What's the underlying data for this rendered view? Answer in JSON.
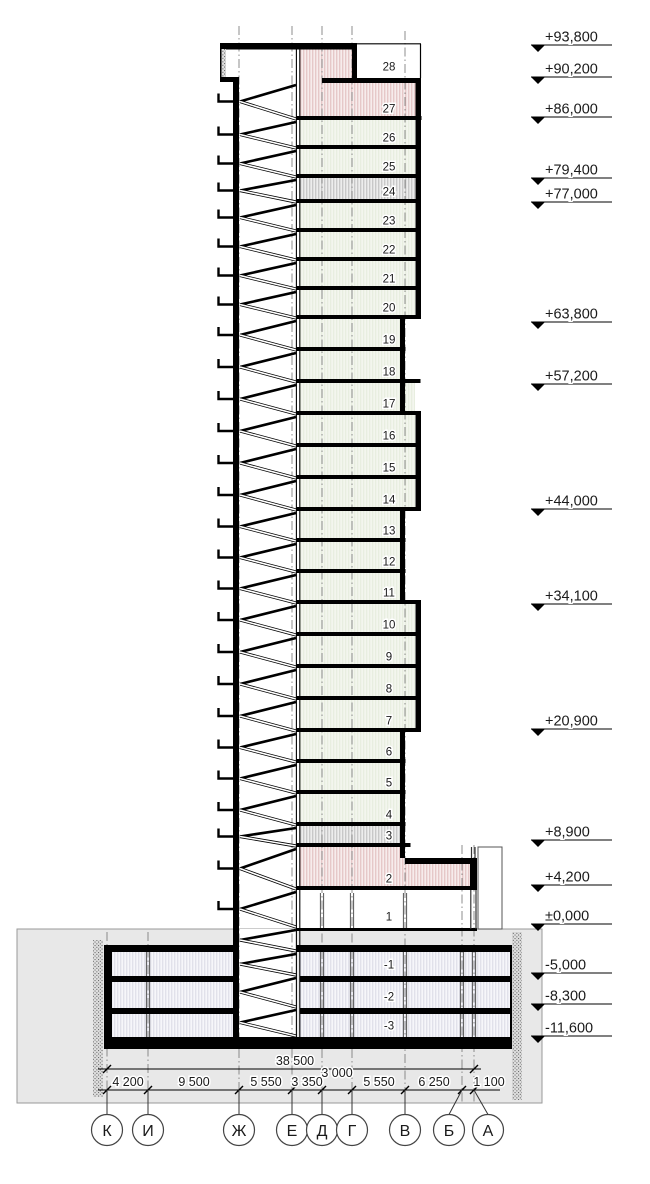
{
  "drawing_type": "building-section",
  "colors": {
    "structure": "#000000",
    "ground": "#e8e8e8",
    "unit_floor": "#f3f6ee",
    "tech_floor_stripe": "#b5b5b5",
    "pink_floor_stripe": "#dcb4b4",
    "pink_floor_bg": "#f7ecec",
    "basement_stripe": "#d6d6e2",
    "axis_line": "#808080"
  },
  "floors": [
    {
      "label": "28",
      "y1": 45,
      "y2": 78,
      "x1": 357,
      "x2": 420,
      "fill": "white"
    },
    {
      "label": "27",
      "y1": 83,
      "y2": 120,
      "x1": 300,
      "x2": 416,
      "fill": "pink"
    },
    {
      "label": "26",
      "y1": 120,
      "y2": 149,
      "x1": 300,
      "x2": 415,
      "fill": "unit"
    },
    {
      "label": "25",
      "y1": 149,
      "y2": 178,
      "x1": 300,
      "x2": 415,
      "fill": "unit"
    },
    {
      "label": "24",
      "y1": 178,
      "y2": 203,
      "x1": 300,
      "x2": 415,
      "fill": "tech"
    },
    {
      "label": "23",
      "y1": 203,
      "y2": 232,
      "x1": 300,
      "x2": 415,
      "fill": "unit"
    },
    {
      "label": "22",
      "y1": 232,
      "y2": 261,
      "x1": 300,
      "x2": 415,
      "fill": "unit"
    },
    {
      "label": "21",
      "y1": 261,
      "y2": 290,
      "x1": 300,
      "x2": 415,
      "fill": "unit"
    },
    {
      "label": "20",
      "y1": 290,
      "y2": 319,
      "x1": 300,
      "x2": 415,
      "fill": "unit"
    },
    {
      "label": "19",
      "y1": 319,
      "y2": 351,
      "x1": 300,
      "x2": 400,
      "fill": "unit"
    },
    {
      "label": "18",
      "y1": 351,
      "y2": 383,
      "x1": 300,
      "x2": 400,
      "fill": "unit"
    },
    {
      "label": "17",
      "y1": 383,
      "y2": 415,
      "x1": 300,
      "x2": 415,
      "fill": "unit"
    },
    {
      "label": "16",
      "y1": 415,
      "y2": 447,
      "x1": 300,
      "x2": 415,
      "fill": "unit"
    },
    {
      "label": "15",
      "y1": 447,
      "y2": 479,
      "x1": 300,
      "x2": 415,
      "fill": "unit"
    },
    {
      "label": "14",
      "y1": 479,
      "y2": 511,
      "x1": 300,
      "x2": 415,
      "fill": "unit"
    },
    {
      "label": "13",
      "y1": 511,
      "y2": 542,
      "x1": 300,
      "x2": 400,
      "fill": "unit"
    },
    {
      "label": "12",
      "y1": 542,
      "y2": 573,
      "x1": 300,
      "x2": 400,
      "fill": "unit"
    },
    {
      "label": "11",
      "y1": 573,
      "y2": 604,
      "x1": 300,
      "x2": 400,
      "fill": "unit"
    },
    {
      "label": "10",
      "y1": 604,
      "y2": 636,
      "x1": 300,
      "x2": 415,
      "fill": "unit"
    },
    {
      "label": "9",
      "y1": 636,
      "y2": 668,
      "x1": 300,
      "x2": 415,
      "fill": "unit"
    },
    {
      "label": "8",
      "y1": 668,
      "y2": 700,
      "x1": 300,
      "x2": 415,
      "fill": "unit"
    },
    {
      "label": "7",
      "y1": 700,
      "y2": 732,
      "x1": 300,
      "x2": 415,
      "fill": "unit"
    },
    {
      "label": "6",
      "y1": 732,
      "y2": 763,
      "x1": 300,
      "x2": 400,
      "fill": "unit"
    },
    {
      "label": "5",
      "y1": 763,
      "y2": 794,
      "x1": 300,
      "x2": 400,
      "fill": "unit"
    },
    {
      "label": "4",
      "y1": 794,
      "y2": 826,
      "x1": 300,
      "x2": 400,
      "fill": "unit"
    },
    {
      "label": "3",
      "y1": 826,
      "y2": 847,
      "x1": 300,
      "x2": 400,
      "fill": "tech"
    },
    {
      "label": "2",
      "y1": 847,
      "y2": 890,
      "x1": 300,
      "x2": 405,
      "fill": "pink"
    },
    {
      "label": "1",
      "y1": 890,
      "y2": 928,
      "x1": 300,
      "x2": 470,
      "fill": "white"
    },
    {
      "label": "-1",
      "y1": 952,
      "y2": 976,
      "x1": 112,
      "x2": 510,
      "fill": "base"
    },
    {
      "label": "-2",
      "y1": 982,
      "y2": 1008,
      "x1": 112,
      "x2": 510,
      "fill": "base"
    },
    {
      "label": "-3",
      "y1": 1014,
      "y2": 1037,
      "x1": 112,
      "x2": 510,
      "fill": "base"
    }
  ],
  "elevations": [
    {
      "label": "+93,800",
      "y": 45
    },
    {
      "label": "+90,200",
      "y": 77
    },
    {
      "label": "+86,000",
      "y": 117
    },
    {
      "label": "+79,400",
      "y": 178
    },
    {
      "label": "+77,000",
      "y": 202
    },
    {
      "label": "+63,800",
      "y": 322
    },
    {
      "label": "+57,200",
      "y": 384
    },
    {
      "label": "+44,000",
      "y": 509
    },
    {
      "label": "+34,100",
      "y": 604
    },
    {
      "label": "+20,900",
      "y": 729
    },
    {
      "label": "+8,900",
      "y": 840
    },
    {
      "label": "+4,200",
      "y": 885
    },
    {
      "label": "±0,000",
      "y": 924
    },
    {
      "label": "-5,000",
      "y": 973
    },
    {
      "label": "-8,300",
      "y": 1004
    },
    {
      "label": "-11,600",
      "y": 1036
    }
  ],
  "axes": [
    {
      "label": "К",
      "x": 107,
      "bx": 107,
      "top": 932
    },
    {
      "label": "И",
      "x": 148,
      "bx": 148,
      "top": 932
    },
    {
      "label": "Ж",
      "x": 239,
      "bx": 239,
      "top": 26
    },
    {
      "label": "Е",
      "x": 292,
      "bx": 292,
      "top": 26
    },
    {
      "label": "Д",
      "x": 322,
      "bx": 322,
      "top": 26
    },
    {
      "label": "Г",
      "x": 352,
      "bx": 352,
      "top": 26
    },
    {
      "label": "В",
      "x": 405,
      "bx": 405,
      "top": 31
    },
    {
      "label": "Б",
      "x": 462,
      "bx": 449,
      "top": 845
    },
    {
      "label": "А",
      "x": 474,
      "bx": 488,
      "top": 845
    }
  ],
  "dimensions": {
    "overall": {
      "label": "38 500",
      "x1": 107,
      "x2": 474,
      "y": 1069,
      "text_cx": 295
    },
    "inset": {
      "label": "3 000",
      "cx": 337,
      "y": 1073
    },
    "segments": {
      "y": 1090,
      "items": [
        {
          "label": "4 200",
          "cx": 128
        },
        {
          "label": "9 500",
          "cx": 194
        },
        {
          "label": "5 550",
          "cx": 266
        },
        {
          "label": "3 350",
          "cx": 307
        },
        {
          "label": "5 550",
          "cx": 379
        },
        {
          "label": "6 250",
          "cx": 434
        },
        {
          "label": "1 100",
          "cx": 489
        }
      ]
    }
  },
  "stair_lines": [
    83,
    120,
    149,
    178,
    203,
    232,
    261,
    290,
    319,
    351,
    383,
    415,
    447,
    479,
    511,
    542,
    573,
    604,
    636,
    668,
    700,
    732,
    763,
    794,
    826,
    847,
    890,
    928,
    952,
    976,
    1008,
    1037
  ],
  "columns": {
    "basement_x": [
      148,
      322,
      352,
      405,
      462,
      474
    ],
    "basement_bands": [
      [
        952,
        976
      ],
      [
        982,
        1008
      ],
      [
        1014,
        1037
      ]
    ],
    "floor1_x": [
      322,
      352,
      405
    ],
    "floor1_band": [
      893,
      928
    ]
  }
}
